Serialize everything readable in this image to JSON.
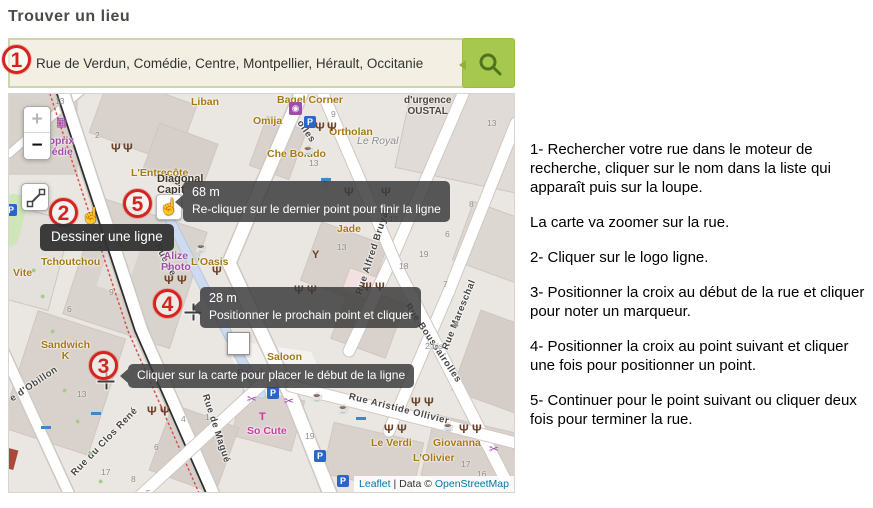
{
  "title": "Trouver un lieu",
  "search": {
    "value": "Rue de Verdun, Comédie, Centre, Montpellier, Hérault, Occitanie"
  },
  "map": {
    "controls": {
      "zoom_in": "+",
      "zoom_out": "−"
    },
    "attribution": {
      "leaflet": "Leaflet",
      "mid": " | Data © ",
      "osm": "OpenStreetMap"
    },
    "streets": [
      {
        "id": "bruyas",
        "label": "Rue Alfred Bruyas",
        "x": 350,
        "y": 195,
        "rot": -72
      },
      {
        "id": "mareschal",
        "label": "Rue Mareschal",
        "x": 436,
        "y": 250,
        "rot": -68
      },
      {
        "id": "boussairolles",
        "label": "Rue Boussairolles",
        "x": 398,
        "y": 205,
        "rot": 56
      },
      {
        "id": "aristide-ollivier",
        "label": "Rue Aristide Ollivier",
        "x": 340,
        "y": 297,
        "rot": 14
      },
      {
        "id": "clos-rene",
        "label": "Rue du Clos René",
        "x": 64,
        "y": 375,
        "rot": -46
      },
      {
        "id": "maguelone",
        "label": "Rue de Magué",
        "x": 196,
        "y": 295,
        "rot": 72
      },
      {
        "id": "obillon",
        "label": "e d'Obillon",
        "x": 2,
        "y": 300,
        "rot": -34
      },
      {
        "id": "verdun",
        "label": "Rue de",
        "x": 148,
        "y": 145,
        "rot": 62
      },
      {
        "id": "olles",
        "label": "olles",
        "x": 290,
        "y": 22,
        "rot": 55
      }
    ],
    "pois": [
      {
        "label": "Liban",
        "x": 182,
        "y": 3,
        "style": "orange"
      },
      {
        "label": "Bagel Corner",
        "x": 268,
        "y": 1,
        "style": "orange"
      },
      {
        "label": "Omija",
        "x": 244,
        "y": 22,
        "style": "orange"
      },
      {
        "label": "Ortholan",
        "x": 320,
        "y": 33,
        "style": "orange"
      },
      {
        "label": "Che Boludo",
        "x": 258,
        "y": 55,
        "style": "orange"
      },
      {
        "label": "Le Royal",
        "x": 348,
        "y": 42,
        "style": "gray"
      },
      {
        "label": "d'urgence\nOUSTAL",
        "x": 395,
        "y": 1,
        "style": "dark"
      },
      {
        "label": "L'Entrecôte",
        "x": 122,
        "y": 74,
        "style": "orange"
      },
      {
        "label": "Monoprix\nComédie",
        "x": 18,
        "y": 42,
        "style": "purple"
      },
      {
        "label": "Diagonal\nCapit",
        "x": 148,
        "y": 80,
        "style": "darkbold"
      },
      {
        "label": "Tchoutchou",
        "x": 32,
        "y": 163,
        "style": "orange"
      },
      {
        "label": "Vite",
        "x": 4,
        "y": 174,
        "style": "orange"
      },
      {
        "label": "Alize\nPhoto",
        "x": 152,
        "y": 157,
        "style": "purple"
      },
      {
        "label": "L'Oasis",
        "x": 182,
        "y": 163,
        "style": "orange"
      },
      {
        "label": "Jade",
        "x": 328,
        "y": 130,
        "style": "orange"
      },
      {
        "label": "Saloon",
        "x": 258,
        "y": 258,
        "style": "orange"
      },
      {
        "label": "Proxi",
        "x": 228,
        "y": 274,
        "style": "purple"
      },
      {
        "label": "So Cute",
        "x": 238,
        "y": 332,
        "style": "magenta"
      },
      {
        "label": "Le Verdi",
        "x": 362,
        "y": 344,
        "style": "orange"
      },
      {
        "label": "Giovanna",
        "x": 424,
        "y": 344,
        "style": "orange"
      },
      {
        "label": "L'Olivier",
        "x": 404,
        "y": 359,
        "style": "orange"
      },
      {
        "label": "Sandwich\nK",
        "x": 32,
        "y": 246,
        "style": "orange"
      }
    ],
    "numbers": [
      {
        "t": "13",
        "x": 46,
        "y": 2
      },
      {
        "t": "16",
        "x": 27,
        "y": 10
      },
      {
        "t": "2",
        "x": 86,
        "y": 36
      },
      {
        "t": "9",
        "x": 322,
        "y": 15
      },
      {
        "t": "13",
        "x": 478,
        "y": 24
      },
      {
        "t": "13",
        "x": 300,
        "y": 64
      },
      {
        "t": "13",
        "x": 328,
        "y": 148
      },
      {
        "t": "17",
        "x": 380,
        "y": 120
      },
      {
        "t": "19",
        "x": 410,
        "y": 155
      },
      {
        "t": "18",
        "x": 390,
        "y": 167
      },
      {
        "t": "6",
        "x": 436,
        "y": 135
      },
      {
        "t": "8",
        "x": 460,
        "y": 105
      },
      {
        "t": "7",
        "x": 434,
        "y": 185
      },
      {
        "t": "3",
        "x": 445,
        "y": 225
      },
      {
        "t": "2 bis",
        "x": 416,
        "y": 247
      },
      {
        "t": "9",
        "x": 100,
        "y": 193
      },
      {
        "t": "6",
        "x": 58,
        "y": 210
      },
      {
        "t": "13",
        "x": 68,
        "y": 295
      },
      {
        "t": "19",
        "x": 296,
        "y": 337
      },
      {
        "t": "4",
        "x": 172,
        "y": 320
      },
      {
        "t": "1",
        "x": 196,
        "y": 318
      },
      {
        "t": "17",
        "x": 452,
        "y": 365
      },
      {
        "t": "16",
        "x": 468,
        "y": 375
      },
      {
        "t": "17",
        "x": 92,
        "y": 373
      },
      {
        "t": "8",
        "x": 122,
        "y": 380
      },
      {
        "t": "5",
        "x": 137,
        "y": 394
      },
      {
        "t": "6",
        "x": 145,
        "y": 348
      }
    ],
    "icons": [
      {
        "type": "restaurant",
        "glyph": "Ψ",
        "x": 102,
        "y": 48
      },
      {
        "type": "restaurant",
        "glyph": "Ψ",
        "x": 114,
        "y": 48
      },
      {
        "type": "restaurant",
        "glyph": "Ψ",
        "x": 306,
        "y": 27
      },
      {
        "type": "restaurant",
        "glyph": "Ψ",
        "x": 318,
        "y": 27
      },
      {
        "type": "restaurant",
        "glyph": "Ψ",
        "x": 335,
        "y": 92
      },
      {
        "type": "restaurant",
        "glyph": "Ψ",
        "x": 372,
        "y": 92
      },
      {
        "type": "restaurant",
        "glyph": "Ψ",
        "x": 155,
        "y": 180
      },
      {
        "type": "restaurant",
        "glyph": "Ψ",
        "x": 168,
        "y": 180
      },
      {
        "type": "restaurant",
        "glyph": "Ψ",
        "x": 203,
        "y": 171
      },
      {
        "type": "restaurant",
        "glyph": "Ψ",
        "x": 285,
        "y": 190
      },
      {
        "type": "restaurant",
        "glyph": "Ψ",
        "x": 298,
        "y": 190
      },
      {
        "type": "restaurant",
        "glyph": "Ψ",
        "x": 353,
        "y": 187
      },
      {
        "type": "restaurant",
        "glyph": "Ψ",
        "x": 366,
        "y": 187
      },
      {
        "type": "restaurant",
        "glyph": "Ψ",
        "x": 138,
        "y": 311
      },
      {
        "type": "restaurant",
        "glyph": "Ψ",
        "x": 151,
        "y": 311
      },
      {
        "type": "restaurant",
        "glyph": "Ψ",
        "x": 375,
        "y": 329
      },
      {
        "type": "restaurant",
        "glyph": "Ψ",
        "x": 388,
        "y": 329
      },
      {
        "type": "restaurant",
        "glyph": "Ψ",
        "x": 402,
        "y": 302
      },
      {
        "type": "restaurant",
        "glyph": "Ψ",
        "x": 415,
        "y": 302
      },
      {
        "type": "restaurant",
        "glyph": "Ψ",
        "x": 450,
        "y": 329
      },
      {
        "type": "restaurant",
        "glyph": "Ψ",
        "x": 463,
        "y": 329
      },
      {
        "type": "cafe",
        "glyph": "☕",
        "x": 186,
        "y": 150
      },
      {
        "type": "cafe",
        "glyph": "☕",
        "x": 293,
        "y": 52
      },
      {
        "type": "cafe",
        "glyph": "☕",
        "x": 302,
        "y": 299
      },
      {
        "type": "cafe",
        "glyph": "☕",
        "x": 328,
        "y": 311
      },
      {
        "type": "cafe",
        "glyph": "☕",
        "x": 433,
        "y": 329
      },
      {
        "type": "cafe",
        "glyph": "☕",
        "x": 310,
        "y": 84
      },
      {
        "type": "bar",
        "glyph": "Y",
        "x": 303,
        "y": 156
      },
      {
        "type": "bar",
        "glyph": "Y",
        "x": 222,
        "y": 217
      },
      {
        "type": "parking",
        "glyph": "P",
        "x": 295,
        "y": 22
      },
      {
        "type": "parking",
        "glyph": "P",
        "x": 258,
        "y": 293
      },
      {
        "type": "parking",
        "glyph": "P",
        "x": 305,
        "y": 356
      },
      {
        "type": "parking",
        "glyph": "P",
        "x": 328,
        "y": 381
      },
      {
        "type": "parking",
        "glyph": "P",
        "x": -4,
        "y": 110
      },
      {
        "type": "bed",
        "glyph": "▬",
        "x": 312,
        "y": 80
      },
      {
        "type": "bed",
        "glyph": "▬",
        "x": 82,
        "y": 314
      },
      {
        "type": "bed",
        "glyph": "▬",
        "x": 32,
        "y": 328
      },
      {
        "type": "bed",
        "glyph": "▬",
        "x": 347,
        "y": 319
      },
      {
        "type": "scissors",
        "glyph": "✂",
        "x": 238,
        "y": 299
      },
      {
        "type": "scissors",
        "glyph": "✂",
        "x": 275,
        "y": 301
      },
      {
        "type": "scissors",
        "glyph": "✂",
        "x": 480,
        "y": 349
      },
      {
        "type": "laundry",
        "glyph": "◉",
        "x": 280,
        "y": 8
      },
      {
        "type": "cart",
        "glyph": "▦",
        "x": 47,
        "y": 22
      },
      {
        "type": "tshirt",
        "glyph": "T",
        "x": 250,
        "y": 318
      },
      {
        "type": "tree",
        "glyph": "●",
        "x": 22,
        "y": 172
      },
      {
        "type": "tree",
        "glyph": "●",
        "x": 31,
        "y": 198
      },
      {
        "type": "tree",
        "glyph": "●",
        "x": 41,
        "y": 233
      },
      {
        "type": "tree",
        "glyph": "●",
        "x": 53,
        "y": 292
      },
      {
        "type": "tree",
        "glyph": "●",
        "x": 66,
        "y": 323
      },
      {
        "type": "tree",
        "glyph": "●",
        "x": 79,
        "y": 355
      },
      {
        "type": "tree",
        "glyph": "●",
        "x": 89,
        "y": 383
      }
    ],
    "crosshairs": [
      {
        "x": 97,
        "y": 287
      },
      {
        "x": 184,
        "y": 218
      }
    ],
    "cursors": [
      {
        "x": 72,
        "y": 112,
        "boxed": false
      },
      {
        "x": 147,
        "y": 100,
        "boxed": true
      }
    ],
    "marker": {
      "x": 218,
      "y": 238
    }
  },
  "annotations": {
    "badges": [
      {
        "n": "1",
        "x": 2,
        "y": 45
      },
      {
        "n": "2",
        "x": 49,
        "y": 198
      },
      {
        "n": "3",
        "x": 89,
        "y": 351
      },
      {
        "n": "4",
        "x": 153,
        "y": 289
      },
      {
        "n": "5",
        "x": 123,
        "y": 189
      }
    ],
    "tooltips": [
      {
        "id": "draw-line",
        "solid": true,
        "arrow": false,
        "x": 40,
        "y": 224,
        "lines": [
          "Dessiner une ligne"
        ]
      },
      {
        "id": "finish-line",
        "solid": false,
        "arrow": true,
        "x": 183,
        "y": 181,
        "lines": [
          "68 m",
          "Re-cliquer sur le dernier point pour finir la ligne"
        ]
      },
      {
        "id": "next-point",
        "solid": false,
        "arrow": true,
        "x": 200,
        "y": 287,
        "lines": [
          "28 m",
          "Positionner le prochain point et cliquer"
        ]
      },
      {
        "id": "start-line",
        "solid": false,
        "arrow": true,
        "x": 128,
        "y": 364,
        "lines": [
          "Cliquer sur la carte pour placer le début de la ligne"
        ]
      }
    ]
  },
  "instructions": {
    "paragraphs": [
      "1- Rechercher votre rue dans le moteur de recherche, cliquer sur le nom dans la liste qui apparaît puis sur la loupe.",
      "La carte va zoomer sur la rue.",
      "2- Cliquer sur le logo ligne.",
      "3- Positionner la croix au début de la rue et cliquer pour noter un marqueur.",
      "4- Positionner la croix au point suivant et cliquer une fois pour positionner un point.",
      "5- Continuer pour le point suivant ou cliquer deux fois pour terminer la rue."
    ]
  }
}
